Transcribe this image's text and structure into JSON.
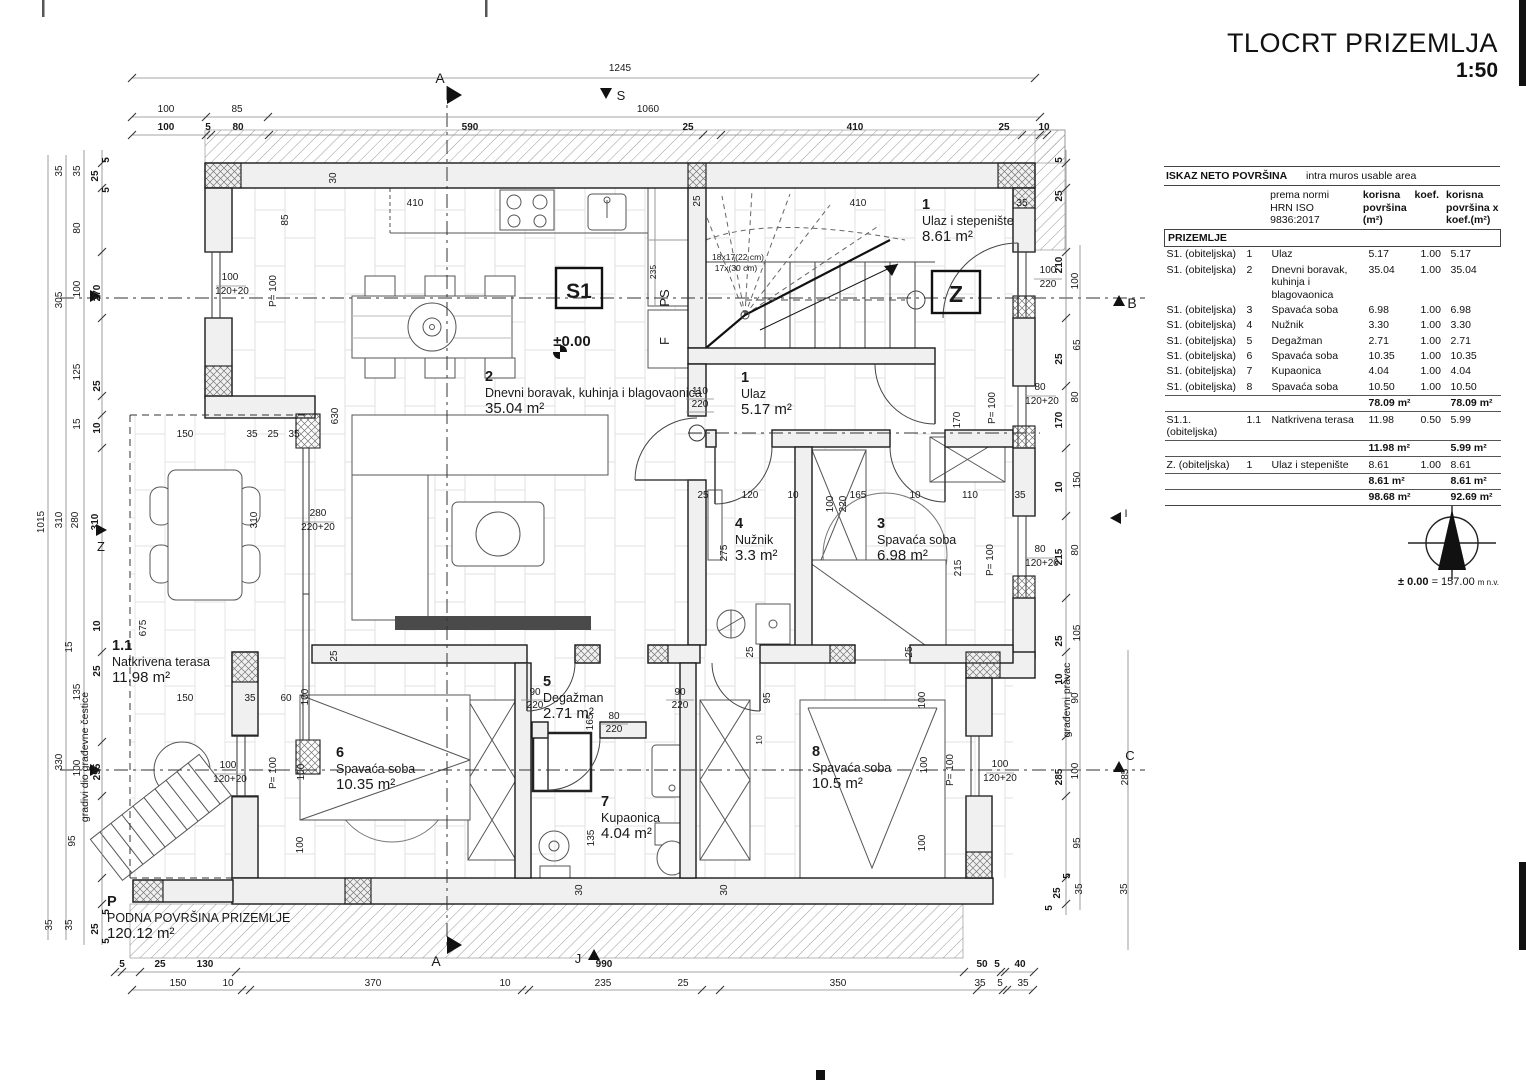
{
  "title": {
    "main": "TLOCRT PRIZEMLJA",
    "scale": "1:50"
  },
  "area_table": {
    "header_left": "ISKAZ NETO POVRŠINA",
    "header_right": "intra muros usable area",
    "col_norm": [
      "prema normi",
      "HRN ISO",
      "9836:2017"
    ],
    "col_area": [
      "korisna",
      "površina",
      "(m²)"
    ],
    "col_koef": "koef.",
    "col_areax": [
      "korisna",
      "površina x",
      "koef.(m²)"
    ],
    "section_label": "PRIZEMLJE",
    "rows": [
      {
        "type": "row",
        "c": [
          "S1. (obiteljska)",
          "1",
          "Ulaz",
          "5.17",
          "1.00",
          "5.17"
        ]
      },
      {
        "type": "row",
        "c": [
          "S1. (obiteljska)",
          "2",
          "Dnevni boravak, kuhinja i blagovaonica",
          "35.04",
          "1.00",
          "35.04"
        ]
      },
      {
        "type": "row",
        "c": [
          "S1. (obiteljska)",
          "3",
          "Spavaća soba",
          "6.98",
          "1.00",
          "6.98"
        ]
      },
      {
        "type": "row",
        "c": [
          "S1. (obiteljska)",
          "4",
          "Nužnik",
          "3.30",
          "1.00",
          "3.30"
        ]
      },
      {
        "type": "row",
        "c": [
          "S1. (obiteljska)",
          "5",
          "Degažman",
          "2.71",
          "1.00",
          "2.71"
        ]
      },
      {
        "type": "row",
        "c": [
          "S1. (obiteljska)",
          "6",
          "Spavaća soba",
          "10.35",
          "1.00",
          "10.35"
        ]
      },
      {
        "type": "row",
        "c": [
          "S1. (obiteljska)",
          "7",
          "Kupaonica",
          "4.04",
          "1.00",
          "4.04"
        ]
      },
      {
        "type": "row",
        "c": [
          "S1. (obiteljska)",
          "8",
          "Spavaća soba",
          "10.50",
          "1.00",
          "10.50"
        ]
      },
      {
        "type": "sub",
        "c": [
          "",
          "",
          "",
          "78.09 m²",
          "",
          "78.09 m²"
        ]
      },
      {
        "type": "row",
        "c": [
          "S1.1. (obiteljska)",
          "1.1",
          "Natkrivena terasa",
          "11.98",
          "0.50",
          "5.99"
        ]
      },
      {
        "type": "sub",
        "c": [
          "",
          "",
          "",
          "11.98 m²",
          "",
          "5.99 m²"
        ]
      },
      {
        "type": "row",
        "c": [
          "Z. (obiteljska)",
          "1",
          "Ulaz i stepenište",
          "8.61",
          "1.00",
          "8.61"
        ]
      },
      {
        "type": "sub",
        "c": [
          "",
          "",
          "",
          "8.61 m²",
          "",
          "8.61 m²"
        ]
      },
      {
        "type": "total",
        "c": [
          "",
          "",
          "",
          "98.68 m²",
          "",
          "92.69 m²"
        ]
      }
    ]
  },
  "north": {
    "level_bold": "± 0.00",
    "level_rest": " = 157.00 ",
    "level_unit": "m n.v."
  },
  "plan": {
    "rooms": [
      {
        "num": "1",
        "name": "Ulaz",
        "area": "5.17 m²",
        "x": 741,
        "y": 382
      },
      {
        "num": "2",
        "name": "Dnevni boravak, kuhinja i blagovaonica",
        "area": "35.04 m²",
        "x": 485,
        "y": 381
      },
      {
        "num": "1",
        "name": "Ulaz i stepenište",
        "area": "8.61 m²",
        "x": 922,
        "y": 209
      },
      {
        "num": "3",
        "name": "Spavaća soba",
        "area": "6.98 m²",
        "x": 877,
        "y": 528
      },
      {
        "num": "4",
        "name": "Nužnik",
        "area": "3.3 m²",
        "x": 735,
        "y": 528
      },
      {
        "num": "5",
        "name": "Degažman",
        "area": "2.71 m²",
        "x": 543,
        "y": 686
      },
      {
        "num": "6",
        "name": "Spavaća soba",
        "area": "10.35 m²",
        "x": 336,
        "y": 757
      },
      {
        "num": "7",
        "name": "Kupaonica",
        "area": "4.04 m²",
        "x": 601,
        "y": 806
      },
      {
        "num": "8",
        "name": "Spavaća soba",
        "area": "10.5 m²",
        "x": 812,
        "y": 756
      },
      {
        "num": "1.1",
        "name": "Natkrivena terasa",
        "area": "11.98 m²",
        "x": 112,
        "y": 650
      },
      {
        "num": "P",
        "name": "PODNA POVRŠINA PRIZEMLJE",
        "area": "120.12 m²",
        "x": 107,
        "y": 906
      }
    ],
    "labels": [
      {
        "t": "S1",
        "x": 579,
        "y": 298,
        "s": 21,
        "b": 1
      },
      {
        "t": "Z",
        "x": 956,
        "y": 302,
        "s": 23,
        "b": 1
      },
      {
        "t": "±0.00",
        "x": 572,
        "y": 346,
        "s": 15,
        "b": 1
      },
      {
        "t": "PS",
        "x": 669,
        "y": 298,
        "s": 13,
        "r": 1
      },
      {
        "t": "F",
        "x": 669,
        "y": 341,
        "s": 13,
        "r": 1
      },
      {
        "t": "235",
        "x": 656,
        "y": 272,
        "s": 8.5,
        "r": 1
      },
      {
        "t": "18x17(22 cm)",
        "x": 738,
        "y": 260,
        "s": 8.5
      },
      {
        "t": "17x(30 cm)",
        "x": 736,
        "y": 271,
        "s": 8.5
      },
      {
        "t": "S",
        "x": 621,
        "y": 100,
        "s": 13
      },
      {
        "t": "J",
        "x": 578,
        "y": 963,
        "s": 13
      },
      {
        "t": "Z",
        "x": 101,
        "y": 551,
        "s": 13
      },
      {
        "t": "I",
        "x": 1126,
        "y": 517,
        "s": 11
      },
      {
        "t": "A",
        "x": 440,
        "y": 83,
        "s": 14
      },
      {
        "t": "A",
        "x": 436,
        "y": 966,
        "s": 14
      },
      {
        "t": "B",
        "x": 1132,
        "y": 308,
        "s": 14
      },
      {
        "t": "C",
        "x": 1130,
        "y": 760,
        "s": 13
      },
      {
        "t": "gradivi dio građevne čestice",
        "x": 88,
        "y": 757,
        "s": 10.5,
        "r": 1
      },
      {
        "t": "građevni pravac",
        "x": 1070,
        "y": 700,
        "s": 10.5,
        "r": 1
      }
    ],
    "dims": [
      [
        "1245",
        620,
        71
      ],
      [
        "100",
        166,
        112
      ],
      [
        "85",
        237,
        112
      ],
      [
        "1060",
        648,
        112
      ],
      [
        "100",
        166,
        130,
        "b"
      ],
      [
        "5",
        208,
        130,
        "b"
      ],
      [
        "80",
        238,
        130,
        "b"
      ],
      [
        "590",
        470,
        130,
        "b"
      ],
      [
        "25",
        688,
        130,
        "b"
      ],
      [
        "410",
        855,
        130,
        "b"
      ],
      [
        "25",
        1004,
        130,
        "b"
      ],
      [
        "10",
        1044,
        130,
        "b"
      ],
      [
        "410",
        415,
        206
      ],
      [
        "410",
        858,
        206
      ],
      [
        "35",
        1022,
        206
      ],
      [
        "30",
        336,
        178,
        "r"
      ],
      [
        "85",
        288,
        220,
        "r"
      ],
      [
        "25",
        700,
        201,
        "r"
      ],
      [
        "35",
        62,
        171,
        "r"
      ],
      [
        "35",
        80,
        171,
        "r"
      ],
      [
        "25",
        98,
        176,
        "rb"
      ],
      [
        "5",
        109,
        160,
        "rb"
      ],
      [
        "5",
        109,
        190,
        "rb"
      ],
      [
        "80",
        80,
        228,
        "r"
      ],
      [
        "305",
        62,
        300,
        "r"
      ],
      [
        "100",
        80,
        289,
        "r"
      ],
      [
        "270",
        100,
        293,
        "rb"
      ],
      [
        "125",
        80,
        372,
        "r"
      ],
      [
        "25",
        100,
        386,
        "rb"
      ],
      [
        "15",
        80,
        424,
        "r"
      ],
      [
        "10",
        100,
        428,
        "rb"
      ],
      [
        "1015",
        44,
        522,
        "r"
      ],
      [
        "310",
        62,
        520,
        "r"
      ],
      [
        "280",
        78,
        520,
        "r"
      ],
      [
        "310",
        98,
        522,
        "rb"
      ],
      [
        "15",
        72,
        647,
        "r"
      ],
      [
        "10",
        100,
        626,
        "rb"
      ],
      [
        "25",
        100,
        671,
        "rb"
      ],
      [
        "135",
        80,
        692,
        "r"
      ],
      [
        "330",
        62,
        762,
        "r"
      ],
      [
        "100",
        80,
        768,
        "r"
      ],
      [
        "295",
        100,
        772,
        "rb"
      ],
      [
        "95",
        75,
        841,
        "r"
      ],
      [
        "35",
        52,
        925,
        "r"
      ],
      [
        "35",
        72,
        925,
        "r"
      ],
      [
        "25",
        98,
        929,
        "rb"
      ],
      [
        "5",
        109,
        912,
        "rb"
      ],
      [
        "5",
        109,
        941,
        "rb"
      ],
      [
        "675",
        146,
        628,
        "r"
      ],
      [
        "150",
        185,
        437
      ],
      [
        "35",
        252,
        437
      ],
      [
        "25",
        273,
        437
      ],
      [
        "35",
        294,
        437
      ],
      [
        "310",
        257,
        520,
        "r"
      ],
      [
        "280",
        318,
        516
      ],
      [
        "220+20",
        318,
        530
      ],
      [
        "630",
        338,
        416,
        "r"
      ],
      [
        "100",
        230,
        280
      ],
      [
        "120+20",
        232,
        294
      ],
      [
        "P= 100",
        276,
        291,
        "r"
      ],
      [
        "150",
        185,
        701
      ],
      [
        "35",
        250,
        701
      ],
      [
        "60",
        286,
        701
      ],
      [
        "100",
        308,
        697,
        "r"
      ],
      [
        "100",
        228,
        768
      ],
      [
        "120+20",
        230,
        782
      ],
      [
        "P= 100",
        276,
        773,
        "r"
      ],
      [
        "100",
        304,
        772,
        "r"
      ],
      [
        "100",
        303,
        845,
        "r"
      ],
      [
        "25",
        337,
        656,
        "r"
      ],
      [
        "110",
        700,
        394
      ],
      [
        "220",
        700,
        407
      ],
      [
        "100",
        1048,
        273
      ],
      [
        "220",
        1048,
        287
      ],
      [
        "100",
        833,
        504,
        "r"
      ],
      [
        "220",
        846,
        504,
        "r"
      ],
      [
        "170",
        960,
        420,
        "r"
      ],
      [
        "P= 100",
        995,
        408,
        "r"
      ],
      [
        "25",
        703,
        498
      ],
      [
        "120",
        750,
        498
      ],
      [
        "10",
        793,
        498
      ],
      [
        "165",
        858,
        498
      ],
      [
        "10",
        915,
        498
      ],
      [
        "110",
        970,
        498
      ],
      [
        "35",
        1020,
        498
      ],
      [
        "275",
        727,
        553,
        "r"
      ],
      [
        "215",
        961,
        568,
        "r"
      ],
      [
        "P= 100",
        993,
        560,
        "r"
      ],
      [
        "90",
        535,
        695
      ],
      [
        "220",
        535,
        708
      ],
      [
        "90",
        680,
        695
      ],
      [
        "220",
        680,
        708
      ],
      [
        "80",
        614,
        719
      ],
      [
        "220",
        614,
        732
      ],
      [
        "165",
        593,
        722,
        "r"
      ],
      [
        "135",
        594,
        838,
        "r"
      ],
      [
        "95",
        770,
        698,
        "r"
      ],
      [
        "25",
        753,
        652,
        "r"
      ],
      [
        "10",
        762,
        740,
        "rs"
      ],
      [
        "30",
        582,
        890,
        "r"
      ],
      [
        "30",
        727,
        890,
        "r"
      ],
      [
        "25",
        912,
        652,
        "r"
      ],
      [
        "100",
        925,
        700,
        "r"
      ],
      [
        "100",
        927,
        765,
        "r"
      ],
      [
        "P= 100",
        953,
        770,
        "r"
      ],
      [
        "100",
        925,
        843,
        "r"
      ],
      [
        "100",
        1000,
        767
      ],
      [
        "120+20",
        1000,
        781
      ],
      [
        "5",
        1062,
        160,
        "rb"
      ],
      [
        "25",
        1062,
        196,
        "rb"
      ],
      [
        "210",
        1062,
        265,
        "rb"
      ],
      [
        "100",
        1078,
        281,
        "r"
      ],
      [
        "65",
        1080,
        345,
        "r"
      ],
      [
        "25",
        1062,
        359,
        "rb"
      ],
      [
        "80",
        1078,
        397,
        "r"
      ],
      [
        "170",
        1062,
        420,
        "rb"
      ],
      [
        "80",
        1040,
        390
      ],
      [
        "120+20",
        1042,
        404
      ],
      [
        "10",
        1062,
        487,
        "rb"
      ],
      [
        "150",
        1080,
        480,
        "r"
      ],
      [
        "215",
        1062,
        557,
        "rb"
      ],
      [
        "80",
        1078,
        550,
        "r"
      ],
      [
        "80",
        1040,
        552
      ],
      [
        "120+20",
        1042,
        566
      ],
      [
        "105",
        1080,
        633,
        "r"
      ],
      [
        "25",
        1062,
        641,
        "rb"
      ],
      [
        "10",
        1062,
        679,
        "rb"
      ],
      [
        "90",
        1078,
        698,
        "r"
      ],
      [
        "285",
        1062,
        777,
        "rb"
      ],
      [
        "100",
        1078,
        771,
        "r"
      ],
      [
        "285",
        1128,
        777,
        "r"
      ],
      [
        "95",
        1080,
        843,
        "r"
      ],
      [
        "35",
        1082,
        889,
        "r"
      ],
      [
        "25",
        1060,
        893,
        "rb"
      ],
      [
        "5",
        1070,
        876,
        "rb"
      ],
      [
        "5",
        1052,
        908,
        "rb"
      ],
      [
        "35",
        1127,
        889,
        "r"
      ],
      [
        "5",
        122,
        967,
        "b"
      ],
      [
        "25",
        160,
        967,
        "b"
      ],
      [
        "130",
        205,
        967,
        "b"
      ],
      [
        "990",
        604,
        967,
        "b"
      ],
      [
        "50",
        982,
        967,
        "b"
      ],
      [
        "5",
        997,
        967,
        "b"
      ],
      [
        "40",
        1020,
        967,
        "b"
      ],
      [
        "150",
        178,
        986
      ],
      [
        "10",
        228,
        986
      ],
      [
        "370",
        373,
        986
      ],
      [
        "10",
        505,
        986
      ],
      [
        "235",
        603,
        986
      ],
      [
        "25",
        683,
        986
      ],
      [
        "350",
        838,
        986
      ],
      [
        "35",
        980,
        986
      ],
      [
        "5",
        1000,
        986
      ],
      [
        "35",
        1023,
        986
      ]
    ]
  }
}
